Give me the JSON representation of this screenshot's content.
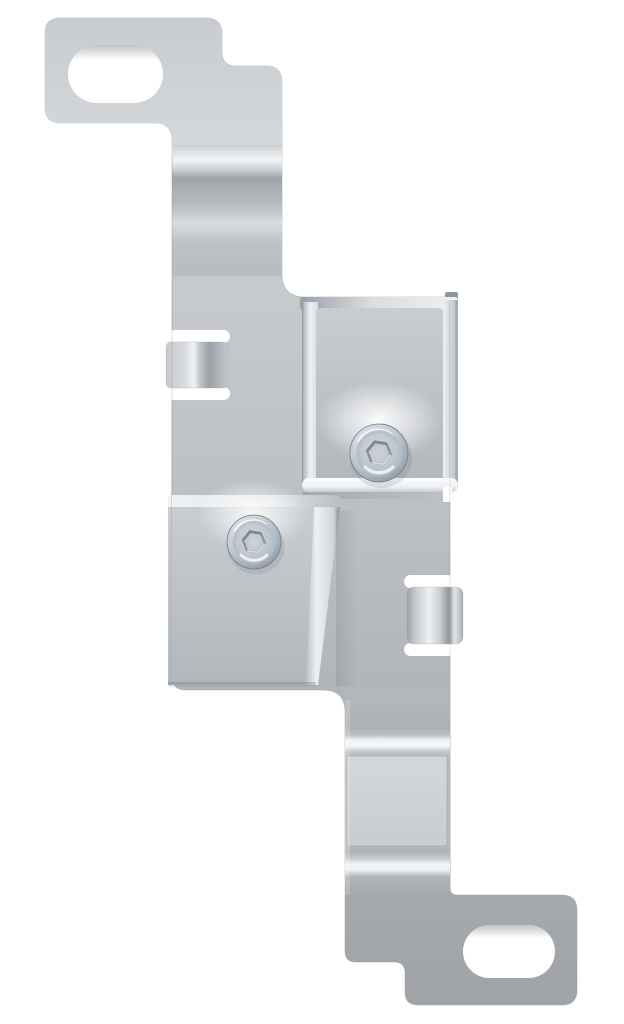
{
  "image": {
    "kind": "product-photo",
    "subject": "sheet-metal mounting bracket",
    "orientation": "vertical",
    "background_style": "plain white studio background"
  },
  "colors": {
    "background": "#ffffff",
    "metal_light": "#d0d4d7",
    "metal_mid": "#bcc0c4",
    "metal_dark": "#a0a3a6",
    "highlight": "#f4f6f7",
    "shadow": "#8f969c",
    "screw_rim": "#8e99a3",
    "screw_face": "#d3d9de",
    "hex_wall": "#868f98"
  },
  "features": {
    "top_tab": {
      "name": "top mounting tab",
      "hole": "obround slot hole"
    },
    "bottom_tab": {
      "name": "bottom mounting tab",
      "hole": "obround slot hole"
    },
    "screws": {
      "count": 2,
      "type": "socket head screw"
    },
    "lance_tabs": {
      "count": 2,
      "description": "bent retaining tabs lanced into left and right edges"
    },
    "raised_bosses": {
      "count": 2,
      "description": "offset raised pads carrying the screws"
    }
  }
}
